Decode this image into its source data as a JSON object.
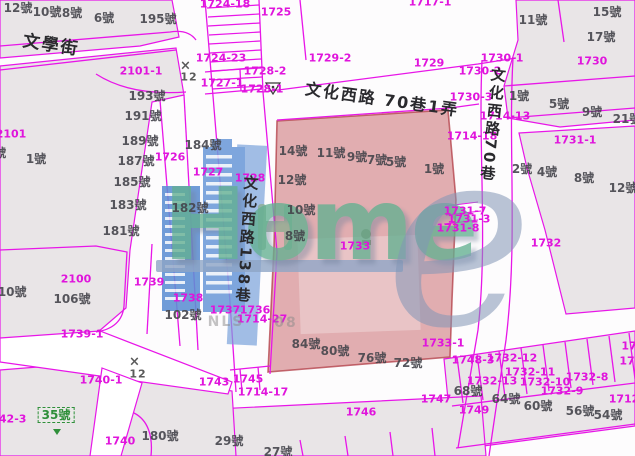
{
  "map": {
    "watermark": {
      "logo_text": "Home",
      "logo_e": "e"
    },
    "colors": {
      "boundary_magenta": "#e816e8",
      "parcel_label": "#e014dc",
      "house_number": "#45454c",
      "highlight_fill": "rgba(197,93,99,0.5)",
      "building_blue": "#6d9bd9",
      "logo_teal": "#63b091",
      "logo_gray_e": "#8296b6",
      "green_label": "#2f8f3a",
      "parcel_gray": "#e9e5e7"
    },
    "labels": [
      {
        "text": "1724-18",
        "x": 225,
        "y": 4,
        "cls": "parcel"
      },
      {
        "text": "1725",
        "x": 276,
        "y": 12,
        "cls": "parcel"
      },
      {
        "text": "1724-23",
        "x": 221,
        "y": 58,
        "cls": "parcel"
      },
      {
        "text": "1728-2",
        "x": 265,
        "y": 71,
        "cls": "parcel"
      },
      {
        "text": "1727-1",
        "x": 222,
        "y": 83,
        "cls": "parcel"
      },
      {
        "text": "1728-1",
        "x": 262,
        "y": 89,
        "cls": "parcel"
      },
      {
        "text": "2101-1",
        "x": 141,
        "y": 71,
        "cls": "parcel"
      },
      {
        "text": "1717-1",
        "x": 430,
        "y": 2,
        "cls": "parcel"
      },
      {
        "text": "1729-2",
        "x": 330,
        "y": 58,
        "cls": "parcel"
      },
      {
        "text": "1729",
        "x": 429,
        "y": 63,
        "cls": "parcel"
      },
      {
        "text": "1730-1",
        "x": 502,
        "y": 58,
        "cls": "parcel"
      },
      {
        "text": "1730-2",
        "x": 480,
        "y": 71,
        "cls": "parcel"
      },
      {
        "text": "1730-3",
        "x": 471,
        "y": 97,
        "cls": "parcel"
      },
      {
        "text": "1730",
        "x": 592,
        "y": 61,
        "cls": "parcel"
      },
      {
        "text": "1714-13",
        "x": 505,
        "y": 116,
        "cls": "parcel"
      },
      {
        "text": "1714-18",
        "x": 472,
        "y": 136,
        "cls": "parcel"
      },
      {
        "text": "1731-1",
        "x": 575,
        "y": 140,
        "cls": "parcel"
      },
      {
        "text": "1731-7",
        "x": 465,
        "y": 211,
        "cls": "parcel"
      },
      {
        "text": "1731-3",
        "x": 469,
        "y": 219,
        "cls": "parcel"
      },
      {
        "text": "1731-8",
        "x": 458,
        "y": 228,
        "cls": "parcel"
      },
      {
        "text": "1732",
        "x": 546,
        "y": 243,
        "cls": "parcel"
      },
      {
        "text": "1733",
        "x": 355,
        "y": 246,
        "cls": "parcel"
      },
      {
        "text": "1733-1",
        "x": 443,
        "y": 343,
        "cls": "parcel"
      },
      {
        "text": "2101",
        "x": 11,
        "y": 134,
        "cls": "parcel"
      },
      {
        "text": "1726",
        "x": 170,
        "y": 157,
        "cls": "parcel"
      },
      {
        "text": "1727",
        "x": 208,
        "y": 172,
        "cls": "parcel"
      },
      {
        "text": "1728",
        "x": 250,
        "y": 178,
        "cls": "parcel"
      },
      {
        "text": "2100",
        "x": 76,
        "y": 279,
        "cls": "parcel"
      },
      {
        "text": "1739",
        "x": 149,
        "y": 282,
        "cls": "parcel"
      },
      {
        "text": "1739-1",
        "x": 82,
        "y": 334,
        "cls": "parcel"
      },
      {
        "text": "1738",
        "x": 188,
        "y": 298,
        "cls": "parcel"
      },
      {
        "text": "1737",
        "x": 225,
        "y": 310,
        "cls": "parcel"
      },
      {
        "text": "1736",
        "x": 255,
        "y": 310,
        "cls": "parcel"
      },
      {
        "text": "1714-27",
        "x": 262,
        "y": 319,
        "cls": "parcel"
      },
      {
        "text": "1740-1",
        "x": 101,
        "y": 380,
        "cls": "parcel"
      },
      {
        "text": "1743",
        "x": 214,
        "y": 382,
        "cls": "parcel"
      },
      {
        "text": "1745",
        "x": 248,
        "y": 379,
        "cls": "parcel"
      },
      {
        "text": "1714-17",
        "x": 263,
        "y": 392,
        "cls": "parcel"
      },
      {
        "text": "1740",
        "x": 120,
        "y": 441,
        "cls": "parcel"
      },
      {
        "text": "1742-3",
        "x": 5,
        "y": 419,
        "cls": "parcel"
      },
      {
        "text": "1746",
        "x": 361,
        "y": 412,
        "cls": "parcel"
      },
      {
        "text": "1747",
        "x": 436,
        "y": 399,
        "cls": "parcel"
      },
      {
        "text": "1749",
        "x": 474,
        "y": 410,
        "cls": "parcel"
      },
      {
        "text": "1748-3",
        "x": 473,
        "y": 360,
        "cls": "parcel"
      },
      {
        "text": "1732-12",
        "x": 512,
        "y": 358,
        "cls": "parcel"
      },
      {
        "text": "1732-11",
        "x": 530,
        "y": 372,
        "cls": "parcel"
      },
      {
        "text": "1732-13",
        "x": 492,
        "y": 381,
        "cls": "parcel"
      },
      {
        "text": "1732-10",
        "x": 545,
        "y": 382,
        "cls": "parcel"
      },
      {
        "text": "1732-8",
        "x": 587,
        "y": 377,
        "cls": "parcel"
      },
      {
        "text": "1732-9",
        "x": 562,
        "y": 391,
        "cls": "parcel"
      },
      {
        "text": "1712",
        "x": 624,
        "y": 399,
        "cls": "parcel"
      },
      {
        "text": "17",
        "x": 629,
        "y": 346,
        "cls": "parcel"
      },
      {
        "text": "17",
        "x": 627,
        "y": 361,
        "cls": "parcel"
      },
      {
        "text": "12號",
        "x": 18,
        "y": 8,
        "cls": "house"
      },
      {
        "text": "10號",
        "x": 47,
        "y": 12,
        "cls": "house"
      },
      {
        "text": "8號",
        "x": 72,
        "y": 13,
        "cls": "house"
      },
      {
        "text": "6號",
        "x": 104,
        "y": 18,
        "cls": "house"
      },
      {
        "text": "195號",
        "x": 158,
        "y": 19,
        "cls": "house"
      },
      {
        "text": "193號",
        "x": 147,
        "y": 96,
        "cls": "house"
      },
      {
        "text": "191號",
        "x": 143,
        "y": 116,
        "cls": "house"
      },
      {
        "text": "189號",
        "x": 140,
        "y": 141,
        "cls": "house"
      },
      {
        "text": "187號",
        "x": 136,
        "y": 161,
        "cls": "house"
      },
      {
        "text": "185號",
        "x": 132,
        "y": 182,
        "cls": "house"
      },
      {
        "text": "183號",
        "x": 128,
        "y": 205,
        "cls": "house"
      },
      {
        "text": "181號",
        "x": 121,
        "y": 231,
        "cls": "house"
      },
      {
        "text": "3號",
        "x": -4,
        "y": 153,
        "cls": "house"
      },
      {
        "text": "1號",
        "x": 36,
        "y": 159,
        "cls": "house"
      },
      {
        "text": "184號",
        "x": 203,
        "y": 145,
        "cls": "house"
      },
      {
        "text": "182號",
        "x": 190,
        "y": 208,
        "cls": "house"
      },
      {
        "text": "110號",
        "x": 8,
        "y": 292,
        "cls": "house"
      },
      {
        "text": "106號",
        "x": 72,
        "y": 299,
        "cls": "house"
      },
      {
        "text": "102號",
        "x": 183,
        "y": 315,
        "cls": "house"
      },
      {
        "text": "180號",
        "x": 160,
        "y": 436,
        "cls": "house"
      },
      {
        "text": "29號",
        "x": 229,
        "y": 441,
        "cls": "house"
      },
      {
        "text": "27號",
        "x": 278,
        "y": 452,
        "cls": "house"
      },
      {
        "text": "14號",
        "x": 293,
        "y": 151,
        "cls": "house"
      },
      {
        "text": "11號",
        "x": 331,
        "y": 153,
        "cls": "house"
      },
      {
        "text": "9號",
        "x": 357,
        "y": 157,
        "cls": "house"
      },
      {
        "text": "7號",
        "x": 377,
        "y": 160,
        "cls": "house"
      },
      {
        "text": "5號",
        "x": 396,
        "y": 162,
        "cls": "house"
      },
      {
        "text": "1號",
        "x": 434,
        "y": 169,
        "cls": "house"
      },
      {
        "text": "12號",
        "x": 292,
        "y": 180,
        "cls": "house"
      },
      {
        "text": "10號",
        "x": 301,
        "y": 210,
        "cls": "house"
      },
      {
        "text": "8號",
        "x": 295,
        "y": 236,
        "cls": "house"
      },
      {
        "text": "84號",
        "x": 306,
        "y": 344,
        "cls": "house"
      },
      {
        "text": "80號",
        "x": 335,
        "y": 351,
        "cls": "house"
      },
      {
        "text": "76號",
        "x": 372,
        "y": 358,
        "cls": "house"
      },
      {
        "text": "72號",
        "x": 408,
        "y": 363,
        "cls": "house"
      },
      {
        "text": "68號",
        "x": 468,
        "y": 391,
        "cls": "house"
      },
      {
        "text": "64號",
        "x": 506,
        "y": 399,
        "cls": "house"
      },
      {
        "text": "60號",
        "x": 538,
        "y": 406,
        "cls": "house"
      },
      {
        "text": "56號",
        "x": 580,
        "y": 411,
        "cls": "house"
      },
      {
        "text": "54號",
        "x": 608,
        "y": 415,
        "cls": "house"
      },
      {
        "text": "11號",
        "x": 533,
        "y": 20,
        "cls": "house"
      },
      {
        "text": "15號",
        "x": 607,
        "y": 12,
        "cls": "house"
      },
      {
        "text": "17號",
        "x": 601,
        "y": 37,
        "cls": "house"
      },
      {
        "text": "1號",
        "x": 519,
        "y": 96,
        "cls": "house"
      },
      {
        "text": "5號",
        "x": 559,
        "y": 104,
        "cls": "house"
      },
      {
        "text": "9號",
        "x": 592,
        "y": 112,
        "cls": "house"
      },
      {
        "text": "21號",
        "x": 627,
        "y": 119,
        "cls": "house"
      },
      {
        "text": "2號",
        "x": 522,
        "y": 169,
        "cls": "house"
      },
      {
        "text": "4號",
        "x": 547,
        "y": 172,
        "cls": "house"
      },
      {
        "text": "8號",
        "x": 584,
        "y": 178,
        "cls": "house"
      },
      {
        "text": "12號",
        "x": 623,
        "y": 188,
        "cls": "house"
      },
      {
        "text": "35號",
        "x": 56,
        "y": 415,
        "cls": "green"
      },
      {
        "text": "文學街",
        "x": 51,
        "y": 46,
        "cls": "street",
        "rot": 9,
        "size": 17
      },
      {
        "text": "文化西路 70巷1弄",
        "x": 382,
        "y": 100,
        "cls": "street",
        "rot": 8
      },
      {
        "text": "文化西路138巷",
        "x": 246,
        "y": 240,
        "cls": "street v",
        "rot": 4
      },
      {
        "text": "文化西路70巷",
        "x": 492,
        "y": 125,
        "cls": "street v",
        "rot": 6
      },
      {
        "text": "×",
        "x": 186,
        "y": 66,
        "cls": "control",
        "size": 13
      },
      {
        "text": "12",
        "x": 189,
        "y": 77,
        "cls": "control"
      },
      {
        "text": "×",
        "x": 135,
        "y": 362,
        "cls": "control",
        "size": 13
      },
      {
        "text": "12",
        "x": 138,
        "y": 374,
        "cls": "control"
      },
      {
        "text": "NLS",
        "x": 226,
        "y": 322,
        "cls": "nls"
      },
      {
        "text": "08",
        "x": 286,
        "y": 323,
        "cls": "nls"
      }
    ]
  }
}
